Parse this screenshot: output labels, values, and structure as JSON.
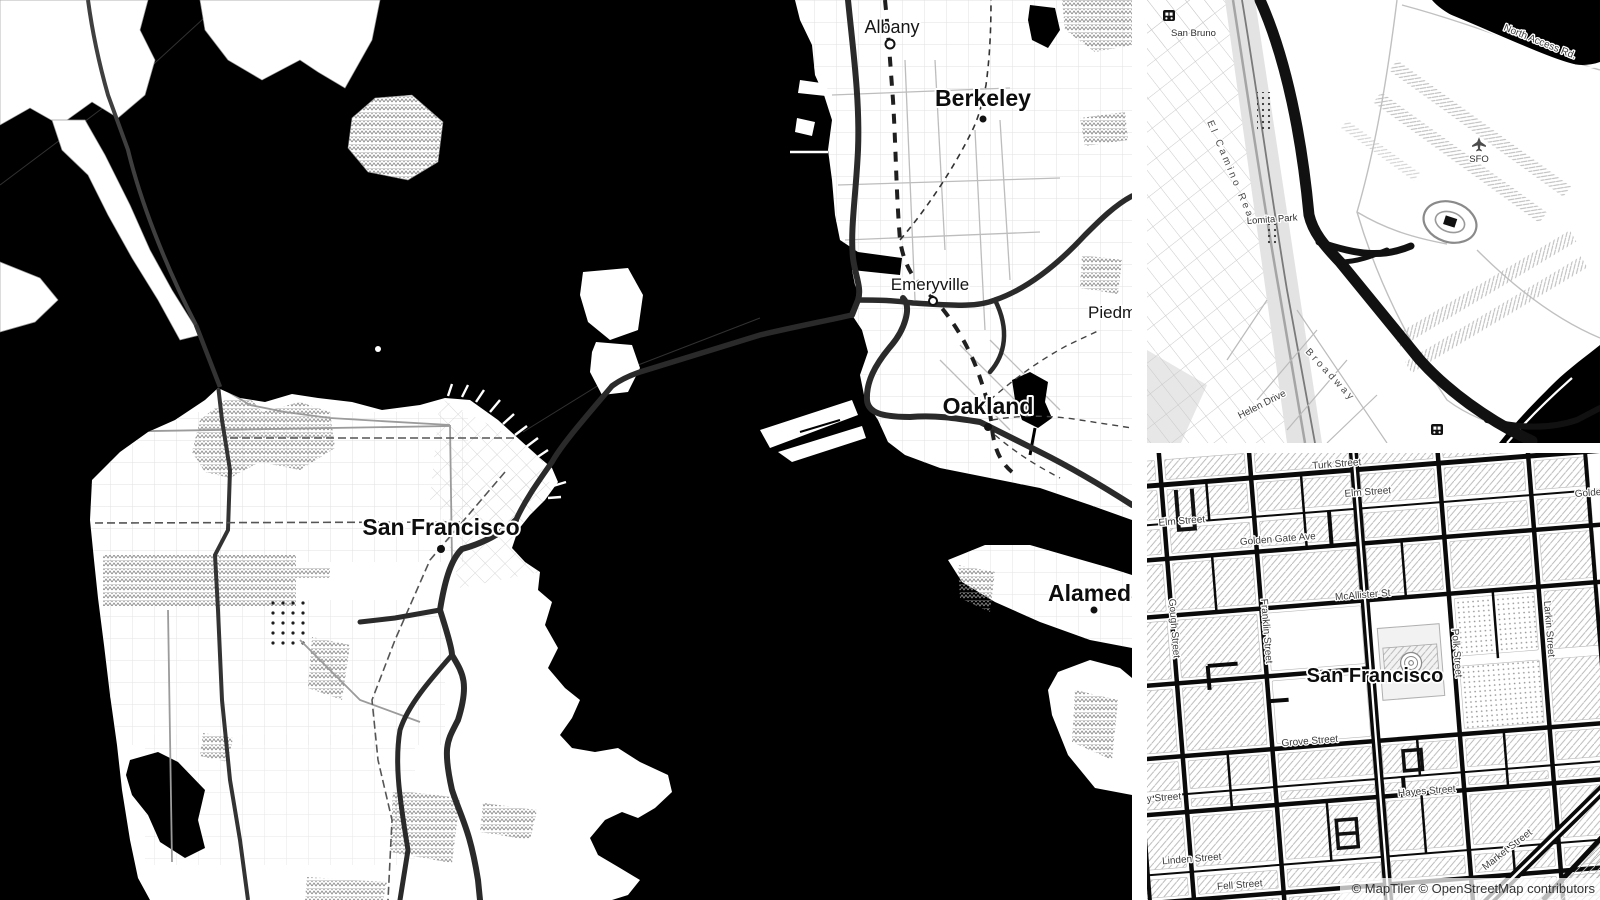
{
  "attribution": {
    "text": "© MapTiler © OpenStreetMap contributors"
  },
  "main_map": {
    "cities": [
      {
        "id": "albany",
        "name": "Albany"
      },
      {
        "id": "berkeley",
        "name": "Berkeley"
      },
      {
        "id": "emeryville",
        "name": "Emeryville"
      },
      {
        "id": "piedmont",
        "name": "Piedmont"
      },
      {
        "id": "oakland",
        "name": "Oakland"
      },
      {
        "id": "san_francisco",
        "name": "San Francisco"
      },
      {
        "id": "alameda",
        "name": "Alameda"
      }
    ]
  },
  "sfo_map": {
    "labels": [
      {
        "id": "san_bruno",
        "text": "San Bruno"
      },
      {
        "id": "el_camino",
        "text": "El Camino Real"
      },
      {
        "id": "lomita_park",
        "text": "Lomita Park"
      },
      {
        "id": "broadway",
        "text": "Broadway"
      },
      {
        "id": "helen_drive",
        "text": "Helen Drive"
      },
      {
        "id": "north_access",
        "text": "North Access Rd."
      },
      {
        "id": "sfo",
        "text": "SFO"
      }
    ]
  },
  "civic_map": {
    "labels": [
      {
        "id": "turk",
        "text": "Turk Street"
      },
      {
        "id": "elm_r",
        "text": "Elm Street"
      },
      {
        "id": "elm_l",
        "text": "Elm Street"
      },
      {
        "id": "golden_gate",
        "text": "Golden Gate Ave"
      },
      {
        "id": "golde",
        "text": "Golde"
      },
      {
        "id": "mcallister",
        "text": "McAllister St"
      },
      {
        "id": "gough",
        "text": "Gough Street"
      },
      {
        "id": "franklin",
        "text": "Franklin Street"
      },
      {
        "id": "polk",
        "text": "Polk Street"
      },
      {
        "id": "larkin",
        "text": "Larkin Street"
      },
      {
        "id": "sf",
        "text": "San Francisco"
      },
      {
        "id": "grove",
        "text": "Grove Street"
      },
      {
        "id": "hayes",
        "text": "Hayes Street"
      },
      {
        "id": "ivy",
        "text": "y Street"
      },
      {
        "id": "linden",
        "text": "Linden Street"
      },
      {
        "id": "fell",
        "text": "Fell Street"
      },
      {
        "id": "market",
        "text": "Market Street"
      }
    ]
  },
  "colors": {
    "water": "#000000",
    "land": "#ffffff",
    "freeway": "#2a2a2a",
    "label": "#333333"
  }
}
